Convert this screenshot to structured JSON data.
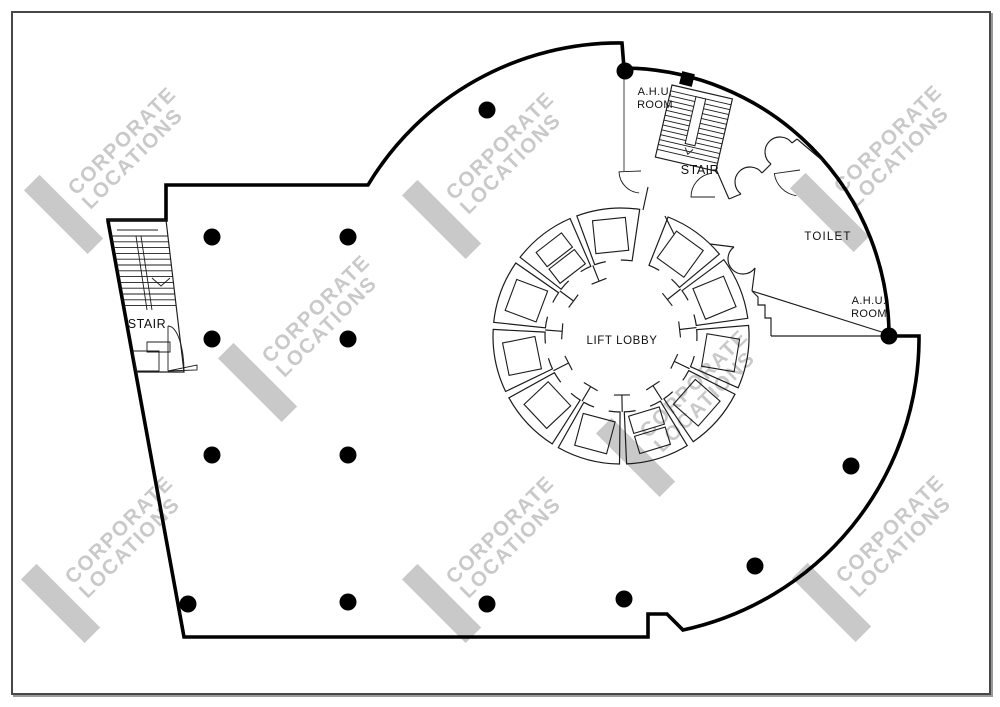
{
  "drawing": {
    "background": "#ffffff",
    "frame_color": "#474747",
    "line_color": "#000000",
    "thin_line_color": "#1c1c1c",
    "gray_wall_color": "#6e6e6e"
  },
  "watermark": {
    "line1": "CORPORATE",
    "line2": "LOCATIONS",
    "color": "#c9c9c9",
    "positions": [
      {
        "x": 118,
        "y": 160
      },
      {
        "x": 496,
        "y": 165
      },
      {
        "x": 884,
        "y": 158
      },
      {
        "x": 312,
        "y": 328
      },
      {
        "x": 690,
        "y": 403
      },
      {
        "x": 115,
        "y": 549
      },
      {
        "x": 496,
        "y": 549
      },
      {
        "x": 886,
        "y": 548
      }
    ]
  },
  "labels": [
    {
      "id": "lift-lobby",
      "lines": [
        "LIFT LOBBY"
      ],
      "x": 622,
      "y": 344,
      "size": 11.5,
      "spacing": 0.6
    },
    {
      "id": "stair-left",
      "lines": [
        "STAIR"
      ],
      "x": 147,
      "y": 328,
      "size": 12.5,
      "spacing": 0.5
    },
    {
      "id": "stair-top",
      "lines": [
        "STAIR"
      ],
      "x": 700,
      "y": 174,
      "size": 12.5,
      "spacing": 0.5
    },
    {
      "id": "toilet",
      "lines": [
        "TOILET"
      ],
      "x": 828,
      "y": 240,
      "size": 11.5,
      "spacing": 1.2
    },
    {
      "id": "ahu-room-top",
      "lines": [
        "A.H.U.",
        "ROOM"
      ],
      "x": 655,
      "y": 95,
      "size": 11,
      "spacing": 0.4
    },
    {
      "id": "ahu-room-right",
      "lines": [
        "A.H.U.",
        "ROOM"
      ],
      "x": 869,
      "y": 304,
      "size": 11,
      "spacing": 0.4
    }
  ],
  "columns": {
    "radius": 8.5,
    "points": [
      [
        212,
        237
      ],
      [
        348,
        237
      ],
      [
        487,
        110
      ],
      [
        625,
        71
      ],
      [
        212,
        339
      ],
      [
        348,
        339
      ],
      [
        212,
        455
      ],
      [
        348,
        455
      ],
      [
        188,
        604
      ],
      [
        348,
        602
      ],
      [
        487,
        604
      ],
      [
        624,
        599
      ],
      [
        755,
        566
      ],
      [
        851,
        466
      ],
      [
        889,
        336
      ]
    ]
  },
  "ring": {
    "cx": 621,
    "cy": 336,
    "outer_r": 128,
    "inner_r": 76,
    "shaft_count": 11,
    "opening_start_deg": -80,
    "opening_end_deg": -70,
    "shaft_gap_deg": 1.6,
    "square_size": 33,
    "square_radius": 101,
    "double_shafts": [
      4,
      9
    ]
  },
  "wall_marker": {
    "x": 687,
    "y": 79,
    "size": 13,
    "rotation_deg": 14
  }
}
